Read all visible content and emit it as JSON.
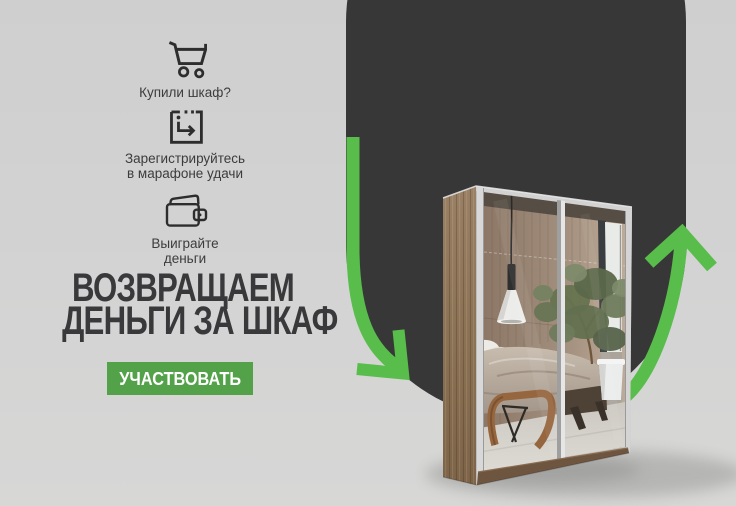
{
  "banner": {
    "type": "promo-banner",
    "language": "ru"
  },
  "steps": [
    {
      "icon": "shopping-cart-icon",
      "lines": [
        "Купили шкаф?"
      ]
    },
    {
      "icon": "register-icon",
      "lines": [
        "Зарегистрируйтесь",
        "в марафоне удачи"
      ]
    },
    {
      "icon": "wallet-icon",
      "lines": [
        "Выиграйте",
        "деньги"
      ]
    }
  ],
  "heading": {
    "line1": "ВОЗВРАЩАЕМ",
    "line2": "ДЕНЬГИ ЗА ШКАФ"
  },
  "cta": {
    "label": "УЧАСТВОВАТЬ"
  },
  "illustration": {
    "elements": [
      "dark-rounded-blob",
      "green-arrow-down-left",
      "green-arrow-up-right",
      "mirrored-sliding-wardrobe"
    ]
  },
  "colors": {
    "background": "#d2d2d2",
    "blob": "#373737",
    "arrow_green": "#58bd4a",
    "button_green": "#53a24a",
    "heading_text": "#39393b",
    "body_text": "#3c3c3c",
    "button_text": "#ffffff"
  }
}
